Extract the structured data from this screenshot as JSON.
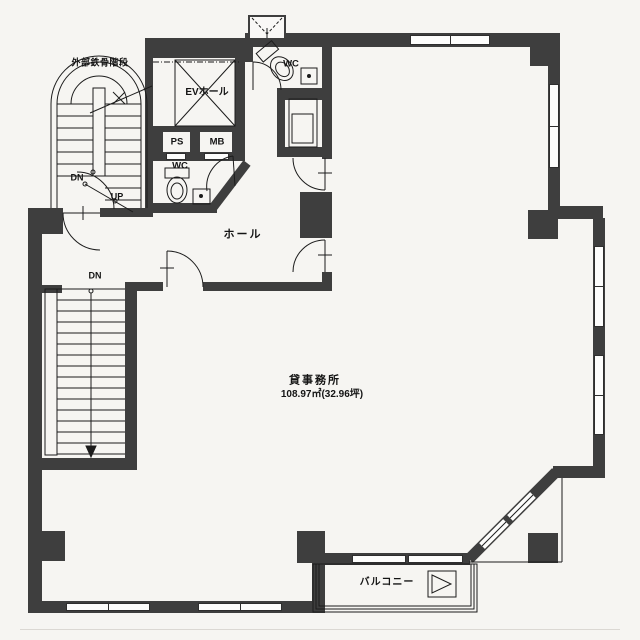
{
  "plan": {
    "labels": {
      "external_stair": "外部鉄骨階段",
      "ev_hall": "EVホール",
      "ps": "PS",
      "mb": "MB",
      "wc_upper": "WC",
      "wc_lower": "WC",
      "hall": "ホール",
      "office_name": "貸事務所",
      "office_area": "108.97㎡(32.96坪)",
      "balcony": "バルコニー",
      "stair_down_external": "DN",
      "stair_up_external": "UP",
      "stair_down_internal": "DN"
    },
    "colors": {
      "wall": "#3e3e3e",
      "line": "#1c1c1c",
      "paper": "#f6f5f2"
    }
  }
}
